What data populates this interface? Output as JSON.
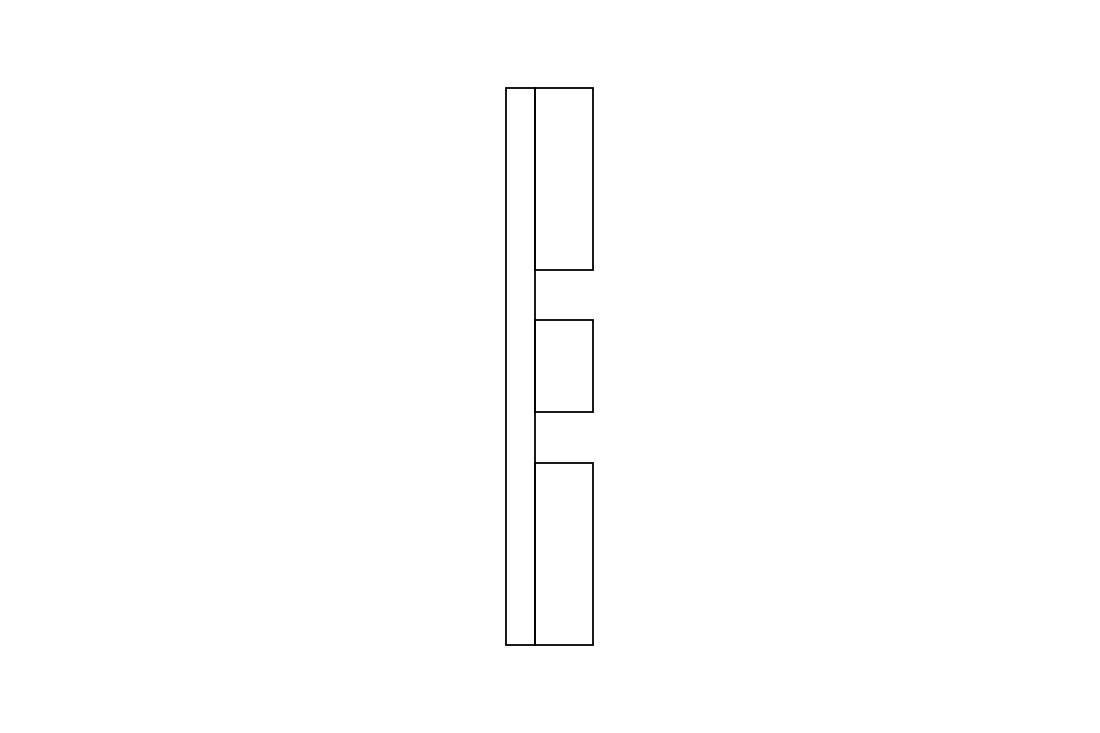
{
  "canvas": {
    "width": 1100,
    "height": 733,
    "background_color": "#ffffff"
  },
  "drawing": {
    "description": "Technical CAD-style line drawing: side profile of a part consisting of a tall narrow back plate with three rectangular teeth projecting from its right edge (top, middle, bottom) separated by two equal gaps",
    "stroke_color": "#000000",
    "stroke_width": 1.8,
    "fill": "none",
    "shapes": [
      {
        "name": "back-plate",
        "type": "rect",
        "x": 506,
        "y": 88,
        "width": 29,
        "height": 557
      },
      {
        "name": "top-tooth",
        "type": "rect",
        "x": 535,
        "y": 88,
        "width": 58,
        "height": 182
      },
      {
        "name": "middle-tooth",
        "type": "rect",
        "x": 535,
        "y": 320,
        "width": 58,
        "height": 92
      },
      {
        "name": "bottom-tooth",
        "type": "rect",
        "x": 535,
        "y": 463,
        "width": 58,
        "height": 182
      }
    ]
  }
}
